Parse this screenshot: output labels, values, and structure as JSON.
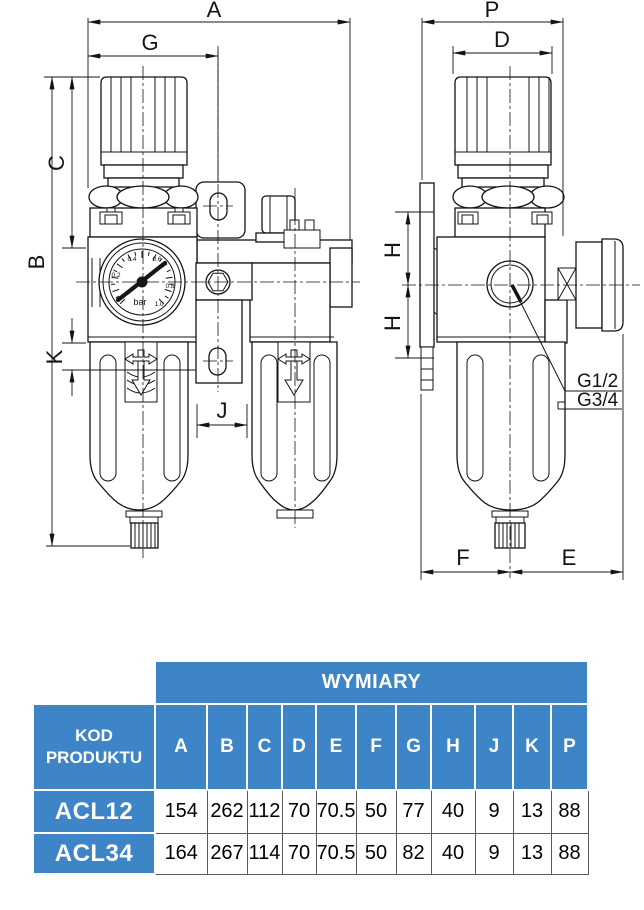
{
  "drawing": {
    "front_view": {
      "dim_overall_width": "A",
      "dim_regulator_width": "G",
      "dim_top_to_center": "C",
      "dim_overall_height": "B",
      "dim_drain_clearance": "K",
      "dim_bowl_gap": "J",
      "gauge": {
        "unit": "bar",
        "ticks": [
          "0.2",
          "0.4",
          "0.6",
          "0.8",
          "1.0"
        ]
      }
    },
    "side_view": {
      "dim_overall_depth": "P",
      "dim_knob_diameter": "D",
      "dim_port_offset": "H",
      "dim_front": "F",
      "dim_rear": "E",
      "port_thread_1": "G1/2",
      "port_thread_2": "G3/4"
    }
  },
  "table": {
    "dimensions_header": "WYMIARY",
    "product_code_header": "KOD PRODUKTU",
    "columns": [
      "A",
      "B",
      "C",
      "D",
      "E",
      "F",
      "G",
      "H",
      "J",
      "K",
      "P"
    ],
    "rows": [
      {
        "code": "ACL12",
        "values": [
          "154",
          "262",
          "112",
          "70",
          "70.5",
          "50",
          "77",
          "40",
          "9",
          "13",
          "88"
        ]
      },
      {
        "code": "ACL34",
        "values": [
          "164",
          "267",
          "114",
          "70",
          "70.5",
          "50",
          "82",
          "40",
          "9",
          "13",
          "88"
        ]
      }
    ]
  },
  "colors": {
    "table_blue": "#3d85c6",
    "line": "#141414"
  }
}
